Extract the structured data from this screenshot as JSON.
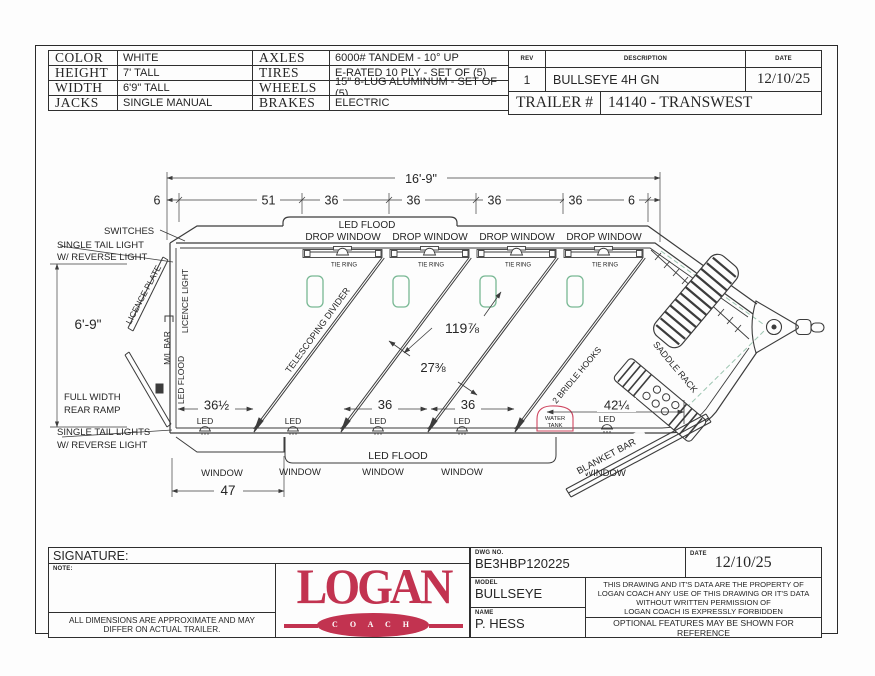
{
  "header": {
    "specs_left": [
      {
        "label": "COLOR",
        "value": "WHITE"
      },
      {
        "label": "HEIGHT",
        "value": "7' TALL"
      },
      {
        "label": "WIDTH",
        "value": "6'9\" TALL"
      },
      {
        "label": "JACKS",
        "value": "SINGLE MANUAL"
      }
    ],
    "specs_right": [
      {
        "label": "AXLES",
        "value": "6000# TANDEM - 10° UP"
      },
      {
        "label": "TIRES",
        "value": "E-RATED 10 PLY - SET OF (5)"
      },
      {
        "label": "WHEELS",
        "value": "15\" 8-LUG ALUMINUM - SET OF (5)"
      },
      {
        "label": "BRAKES",
        "value": "ELECTRIC"
      }
    ],
    "rev_table": {
      "headers": {
        "rev": "REV",
        "description": "DESCRIPTION",
        "date": "DATE"
      },
      "row": {
        "rev": "1",
        "description": "BULLSEYE 4H GN",
        "date": "12/10/25"
      },
      "trailer_label": "TRAILER #",
      "trailer_value": "14140 - TRANSWEST"
    }
  },
  "drawing": {
    "dims": {
      "overall_length": "16'-9\"",
      "end_offset": "6",
      "stall_51": "51",
      "stall_36": "36",
      "body_height": "6'-9\"",
      "rear_window": "47",
      "stall1_floor": "36½",
      "nose_floor": "42¼",
      "divider_length": "119⅞",
      "divider_spacing": "27⅜"
    },
    "labels": {
      "switches": "SWITCHES",
      "tail_light_top1": "SINGLE TAIL LIGHT",
      "tail_light_top2": "W/ REVERSE LIGHT",
      "tail_light_bot1": "SINGLE TAIL LIGHTS",
      "tail_light_bot2": "W/ REVERSE LIGHT",
      "ramp1": "FULL WIDTH",
      "ramp2": "REAR RAMP",
      "licence_plate": "LICENCE PLATE",
      "licence_light": "LICENCE LIGHT",
      "ml_bar": "M/L BAR",
      "led_flood": "LED FLOOD",
      "led": "LED",
      "drop_window": "DROP WINDOW",
      "tie_ring": "TIE RING",
      "telescoping_divider": "TELESCOPING DIVIDER",
      "window": "WINDOW",
      "water_tank1": "WATER",
      "water_tank2": "TANK",
      "bridle_hooks": "2 BRIDLE HOOKS",
      "saddle_rack": "SADDLE RACK",
      "blanket_bar": "BLANKET BAR"
    },
    "colors": {
      "line": "#3c3c3c",
      "red": "#cf4660",
      "vent_green": "#79b894",
      "dash_teal": "#9ec6b2"
    }
  },
  "title_block": {
    "signature_label": "SIGNATURE:",
    "note_label": "NOTE:",
    "disclaimer1": "ALL DIMENSIONS ARE APPROXIMATE AND MAY",
    "disclaimer2": "DIFFER ON ACTUAL TRAILER.",
    "dwg_no_label": "DWG NO.",
    "dwg_no": "BE3HBP120225",
    "date_label": "DATE",
    "date": "12/10/25",
    "model_label": "MODEL",
    "model": "BULLSEYE",
    "name_label": "NAME",
    "name": "P. HESS",
    "property_lines": [
      "THIS DRAWING AND IT'S DATA ARE THE PROPERTY OF",
      "LOGAN COACH ANY USE OF THIS DRAWING OR IT'S DATA",
      "WITHOUT WRITTEN PERMISSION OF",
      "LOGAN COACH IS EXPRESSLY FORBIDDEN"
    ],
    "optional_line": "OPTIONAL FEATURES MAY BE SHOWN FOR REFERENCE"
  },
  "logo": {
    "word": "LOGAN",
    "sub": "C O A C H",
    "color": "#c23350"
  }
}
